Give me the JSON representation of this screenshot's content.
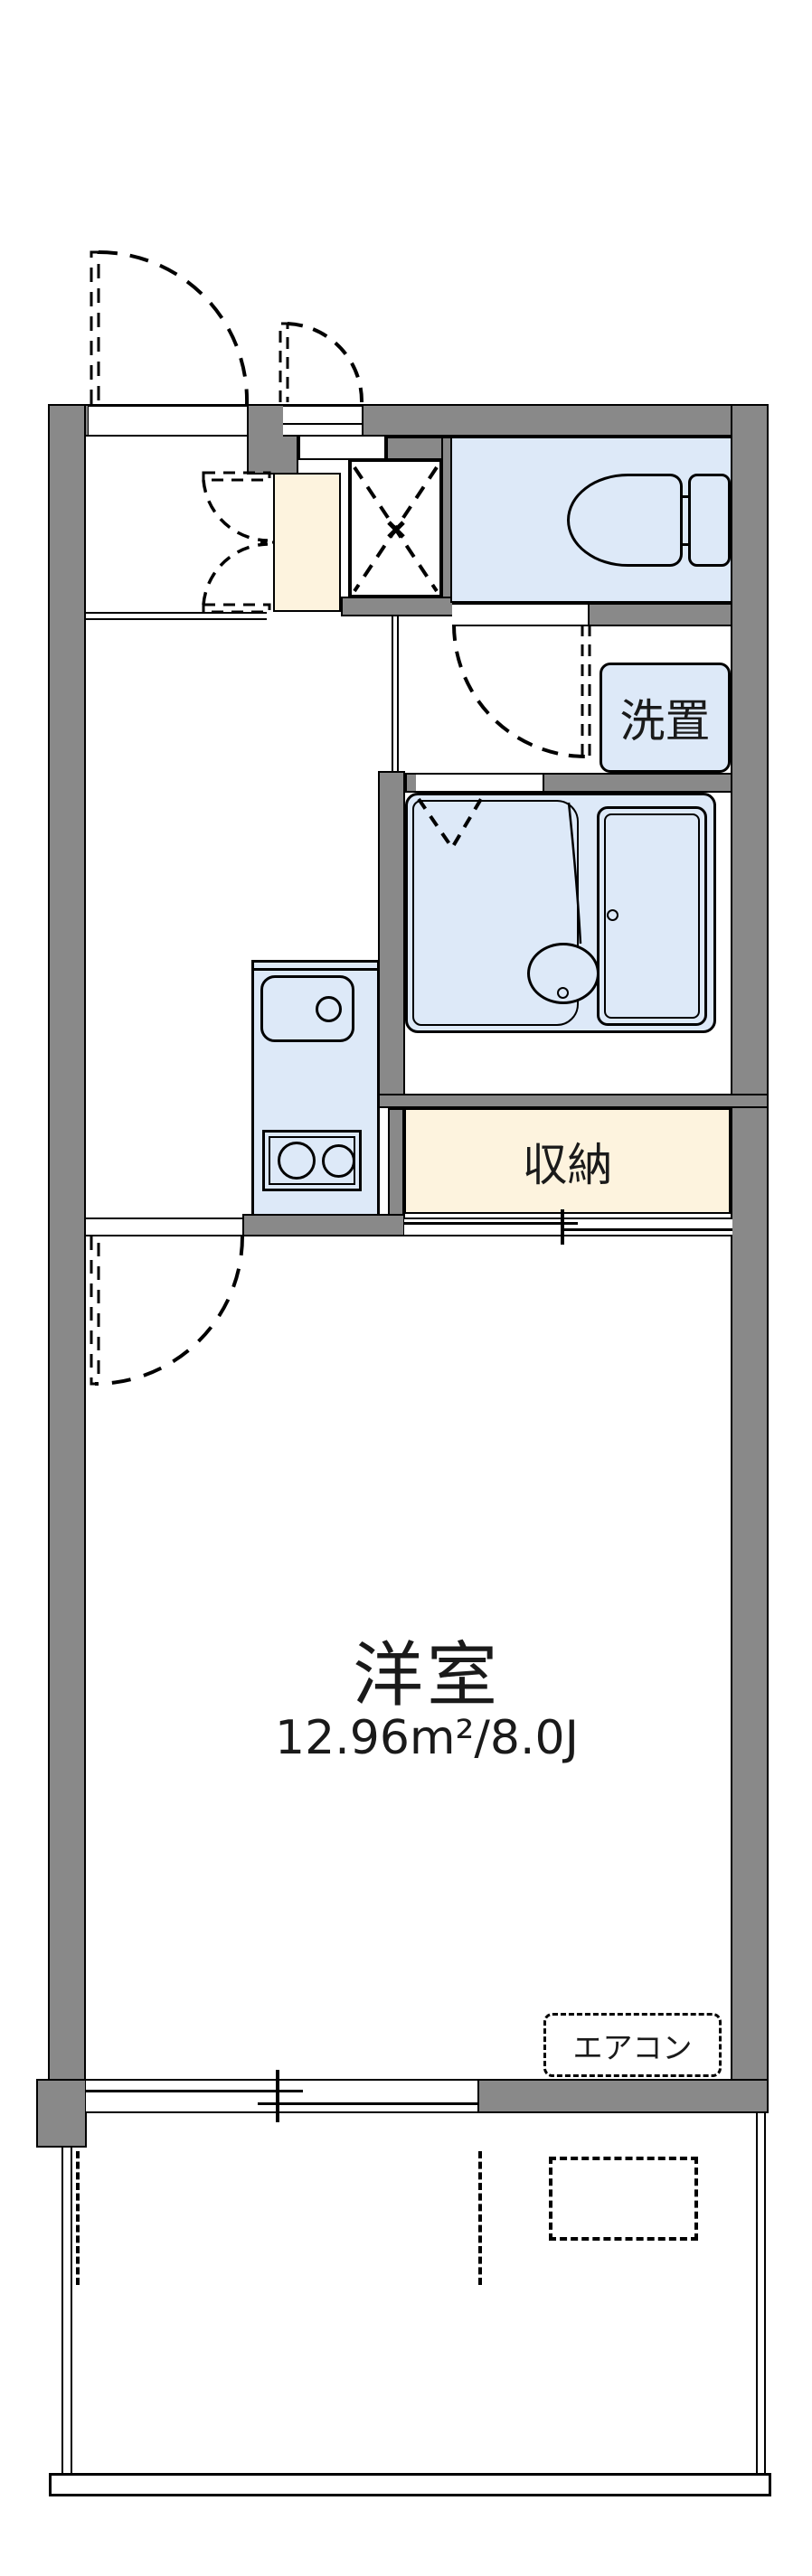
{
  "labels": {
    "main_room_name": "洋室",
    "main_room_area": "12.96m²/8.0J",
    "closet": "収納",
    "laundry": "洗置",
    "aircon": "エアコン"
  },
  "colors": {
    "wall": "#898989",
    "line": "#000000",
    "blue": "#dde9f8",
    "cream": "#fdf3de",
    "bg": "#ffffff"
  }
}
